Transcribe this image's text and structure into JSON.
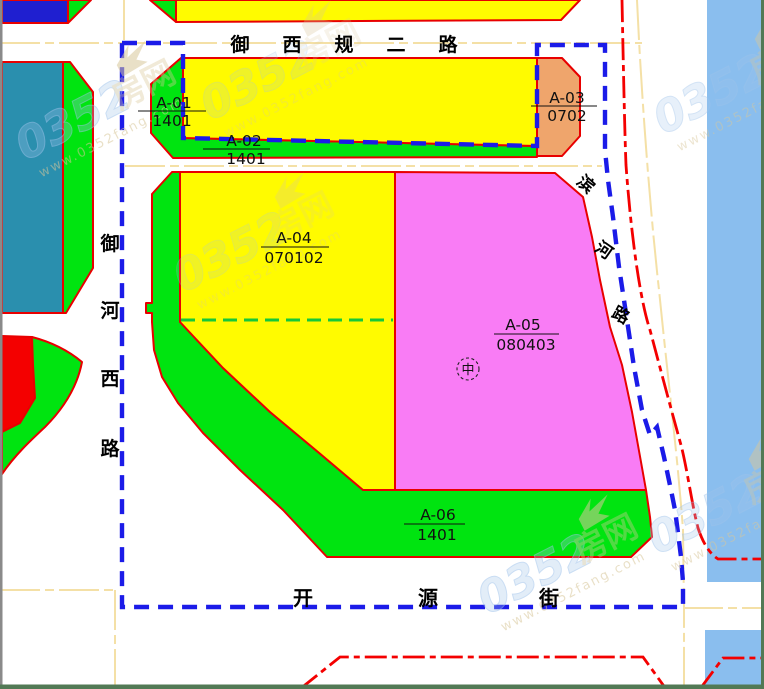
{
  "colors": {
    "parcel-yellow": "#FFFB00",
    "parcel-green": "#00E410",
    "parcel-magenta": "#F97CF5",
    "parcel-orange": "#EFA56C",
    "parcel-teal": "#2A8FAE",
    "parcel-darkblue": "#1F1FD0",
    "parcel-red": "#F40000",
    "river-blue": "#8ABEEE",
    "border-red": "#E80000",
    "boundary-blue": "#1B1BE8",
    "road-tan": "#F4E0A6",
    "dash-green": "#17C837",
    "frame-green": "#527955",
    "frame-grey": "#8A8A8A",
    "label-black": "#111111",
    "wm-blue": "#9FC3EA",
    "wm-tan": "#D8C79A"
  },
  "roads": {
    "north": {
      "name": "御西规二路",
      "chars": [
        "御",
        "西",
        "规",
        "二",
        "路"
      ]
    },
    "west": {
      "name": "御河西路",
      "chars": [
        "御",
        "河",
        "西",
        "路"
      ]
    },
    "east": {
      "name": "滨河路",
      "chars": [
        "滨",
        "河",
        "路"
      ]
    },
    "south": {
      "name": "开源街",
      "chars": [
        "开",
        "源",
        "街"
      ]
    }
  },
  "parcels": [
    {
      "id": "A-01",
      "code": "1401",
      "fill": "green"
    },
    {
      "id": "A-02",
      "code": "1401",
      "fill": "yellow"
    },
    {
      "id": "A-03",
      "code": "0702",
      "fill": "orange"
    },
    {
      "id": "A-04",
      "code": "070102",
      "fill": "yellow"
    },
    {
      "id": "A-05",
      "code": "080403",
      "fill": "magenta"
    },
    {
      "id": "A-06",
      "code": "1401",
      "fill": "green"
    }
  ],
  "marker": {
    "symbol": "中"
  },
  "watermark": {
    "digits": "0352",
    "name": "房网",
    "url": "www.0352fang.com"
  }
}
